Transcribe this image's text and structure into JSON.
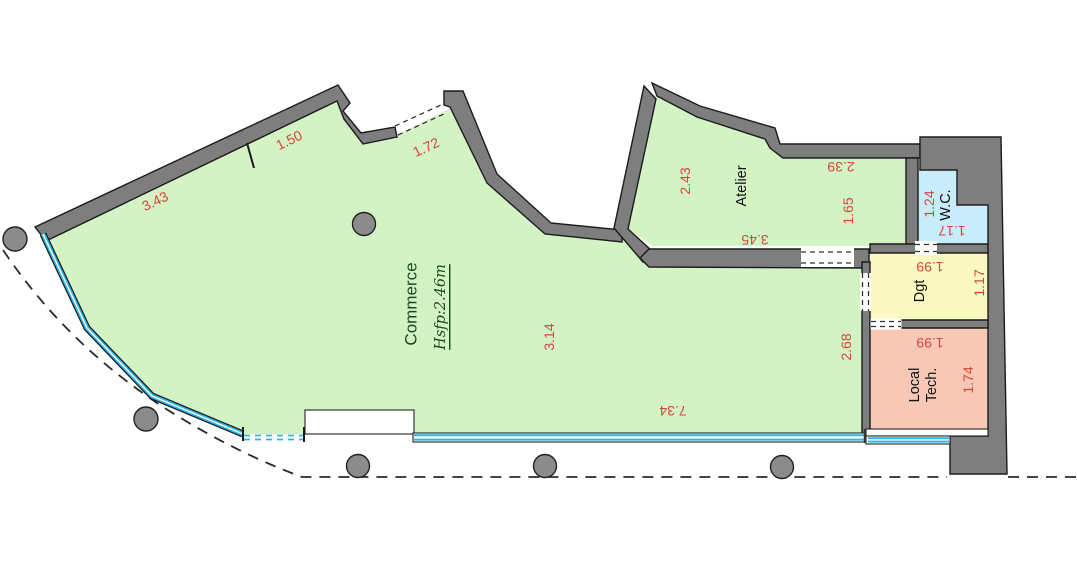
{
  "labels": {
    "commerce": "Commerce",
    "commerce_height": "Hsfp:2.46m",
    "atelier": "Atelier",
    "wc": "W.C.",
    "dgt": "Dgt",
    "local_tech_line1": "Local",
    "local_tech_line2": "Tech."
  },
  "dims": {
    "wall_343": "3.43",
    "wall_150": "1.50",
    "wall_172": "1.72",
    "atelier_243": "2.43",
    "atelier_239": "2.39",
    "atelier_165": "1.65",
    "atelier_345": "3.45",
    "commerce_314": "3.14",
    "commerce_734": "7.34",
    "commerce_268": "2.68",
    "wc_124": "1.24",
    "wc_117": "1.17",
    "dgt_199": "1.99",
    "dgt_117": "1.17",
    "local_tech_199": "1.99",
    "local_tech_174": "1.74"
  },
  "colors": {
    "room_green": "#d3f3c5",
    "room_blue": "#c8ecfa",
    "room_yellow": "#fbf9c2",
    "room_salmon": "#f7c8b5",
    "wall_gray": "#7e7e7e",
    "glass_cyan": "#2db4e8",
    "dimension_red": "#d8453c",
    "label_dark_green": "#1c4a1f"
  }
}
